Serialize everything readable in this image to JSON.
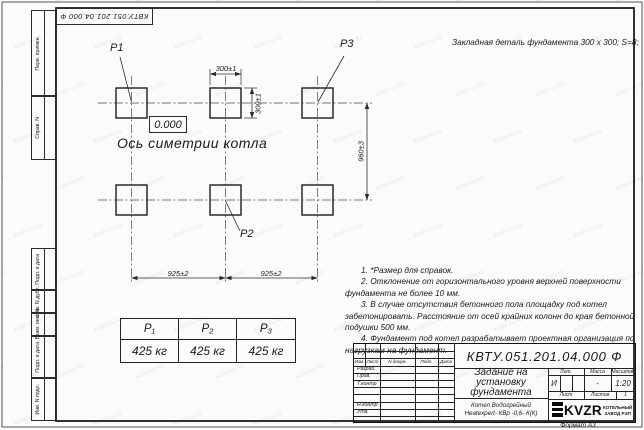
{
  "watermark": {
    "text": "kotel-kv.kz"
  },
  "top_stamp": {
    "doc_number": "КВТУ.051.201.04.000  Ф"
  },
  "header_note": "Закладная деталь фундамента  300 x 300;  S=8;",
  "left_margin": {
    "fields": [
      "Перв. примен.",
      "Справ. N",
      "Подп. и дата",
      "Инв. N дубл.",
      "Взам. инв. N",
      "Подп. и дата",
      "Инв. N подл."
    ]
  },
  "drawing": {
    "labels": {
      "p1": "P1",
      "p2": "P2",
      "p3": "P3"
    },
    "dimensions": {
      "width_top": "300±1",
      "height_side": "300±1",
      "vertical_span": "960±3",
      "span_left": "925±2",
      "span_right": "925±2"
    },
    "elevation": "0.000",
    "axis_label": "Ось симетрии котла"
  },
  "notes": [
    "1. *Размер для справок.",
    "2. Отклонение от горизонтального уровня верхней поверхности фундамента не более 10 мм.",
    "3. В случае отсутствия бетонного пола площадку под котел забетонировать. Расстояние от осей крайних колонн до края бетонной подушки 500 мм.",
    "4. Фундамент под котел разрабатывает проектная организация по нагрузкам на фундамент."
  ],
  "load_table": {
    "headers": [
      "P₁",
      "P₂",
      "P₃"
    ],
    "values": [
      "425 кг",
      "425 кг",
      "425 кг"
    ]
  },
  "title_block": {
    "doc_number": "КВТУ.051.201.04.000  Ф",
    "title": "Задание на\nустановку\nфундамента",
    "product": "Котел Водогрейный\nHeatexpert- КВр -0,6- К(К)",
    "header_cols": [
      "Изм.",
      "Лист",
      "N докум.",
      "Подп.",
      "Дата"
    ],
    "rows": [
      "Разраб.",
      "Пров.",
      "Т.контр",
      "Н.контр",
      "Утв."
    ],
    "lit_label": "Лит.",
    "lit_value": "И",
    "mass_label": "Масса",
    "mass_value": "-",
    "scale_label": "Масштаб",
    "scale_value": "1:20",
    "sheet_label": "Лист",
    "sheets_label": "Листов",
    "sheets_value": "1",
    "logo_text": "KVZR",
    "company": "КОТЕЛЬНЫЙ\nЗАВОД РЭП",
    "format_label": "Формат А3"
  }
}
